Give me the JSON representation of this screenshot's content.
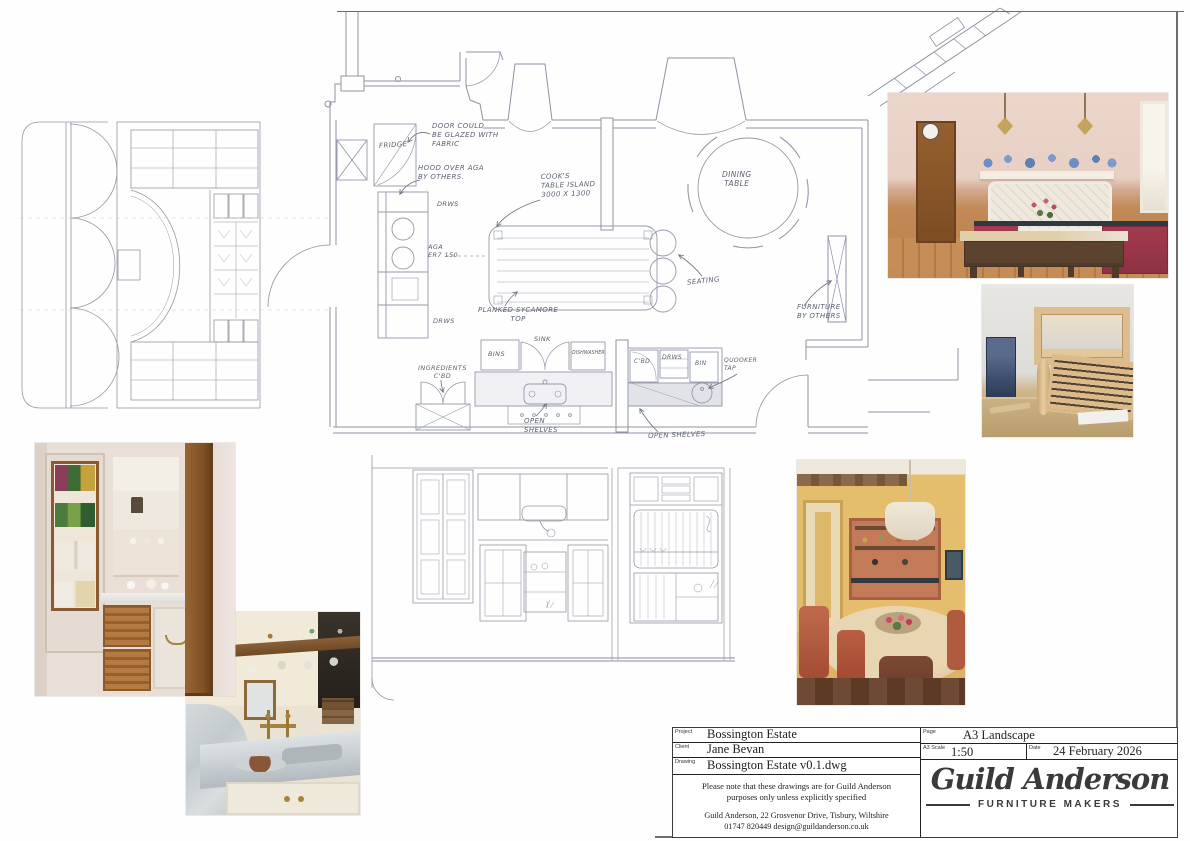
{
  "sheet": {
    "background": "#fefefe",
    "cad_line_color": "#8d92a6",
    "pencil_color": "#9598a4",
    "handwriting_color": "#5c6170"
  },
  "annotations": [
    {
      "id": "door-glazed",
      "text": "DOOR COULD\nBE GLAZED WITH\nFABRIC"
    },
    {
      "id": "fridge",
      "text": "FRIDGE"
    },
    {
      "id": "hood-over-aga",
      "text": "HOOD OVER AGA\nBY OTHERS."
    },
    {
      "id": "drawers-top",
      "text": "DRWS"
    },
    {
      "id": "aga",
      "text": "AGA\nER7 150"
    },
    {
      "id": "drawers-bottom",
      "text": "DRWS"
    },
    {
      "id": "cooks-table",
      "text": "COOK'S\nTABLE ISLAND\n3000 X 1300"
    },
    {
      "id": "dining-table",
      "text": "DINING\nTABLE"
    },
    {
      "id": "seating",
      "text": "SEATING"
    },
    {
      "id": "furniture-by-others",
      "text": "FURNITURE\nBY OTHERS"
    },
    {
      "id": "planked-top",
      "text": "PLANKED SYCAMORE\nTOP"
    },
    {
      "id": "bins",
      "text": "BINS"
    },
    {
      "id": "sink",
      "text": "SINK"
    },
    {
      "id": "dishwasher",
      "text": "DISHWASHER"
    },
    {
      "id": "ingredients-cupboard",
      "text": "INGREDIENTS\nC'BD"
    },
    {
      "id": "open-shelves-left",
      "text": "OPEN\nSHELVES"
    },
    {
      "id": "cupboard",
      "text": "C'BD"
    },
    {
      "id": "drawers-right",
      "text": "DRWS"
    },
    {
      "id": "bin",
      "text": "BIN"
    },
    {
      "id": "quooker-tap",
      "text": "QUOOKER\nTAP"
    },
    {
      "id": "open-shelves-right",
      "text": "OPEN SHELVES"
    }
  ],
  "photos": {
    "kitchen_inspiration": {
      "description": "kitchen with pink walls, crimson cabinets, antique wood island, blue plates over mantel",
      "colors": {
        "wall": "#ead3c8",
        "cabinet": "#a03a50",
        "island_wood": "#5c4330",
        "floor": "#c28a57",
        "plates": "#6f8fc0"
      }
    },
    "workshop": {
      "description": "oak table frame with slatted rack on workshop bench",
      "colors": {
        "wall": "#e4e3e0",
        "oak": "#e0c296",
        "bench": "#c3ab7c",
        "machine": "#44577c"
      }
    },
    "pantry": {
      "description": "cream pantry cupboard with door spice racks, corner shelves and wicker basket drawers",
      "colors": {
        "paint": "#e9dfd6",
        "oak": "#8a5a33",
        "basket": "#b47a42"
      }
    },
    "marble_counter": {
      "description": "carrara marble worktop with brass taps and hanging mugs shelf",
      "colors": {
        "marble": "#c9cfd2",
        "brass": "#a5823e",
        "wall": "#f0e8d8",
        "shelf_wood": "#7c5733"
      }
    },
    "dining_room": {
      "description": "yellow dining room, terracotta dresser, round table and leather chairs",
      "colors": {
        "wall": "#e5be6d",
        "dresser": "#c27a58",
        "table": "#ddc7a2",
        "chairs": "#b05a40",
        "lamp": "#ece5d6"
      }
    }
  },
  "title_block": {
    "project_label": "Project",
    "project": "Bossington Estate",
    "client_label": "Client",
    "client": "Jane Bevan",
    "drawing_label": "Drawing",
    "drawing": "Bossington Estate v0.1.dwg",
    "page_label": "Page",
    "page": "A3 Landscape",
    "scale_label": "A3 Scale",
    "scale": "1:50",
    "date_label": "Date",
    "date": "24 February 2026",
    "note": "Please note that these drawings are for Guild Anderson\npurposes only unless explicitly specified",
    "address": "Guild Anderson, 22 Grosvenor Drive, Tisbury, Wiltshire",
    "contact": "01747 820449   design@guildanderson.co.uk",
    "logo_text": "Guild Anderson",
    "logo_subtitle": "FURNITURE MAKERS"
  }
}
